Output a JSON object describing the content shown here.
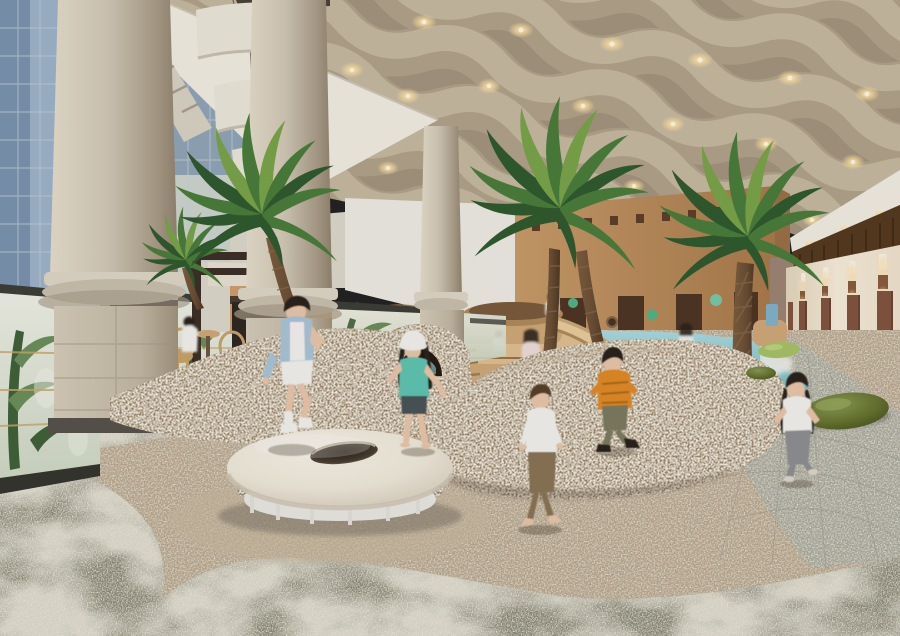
{
  "meta": {
    "title": "Indoor kids playground - architectural concept rendering",
    "type": "photorealistic-render",
    "width": 900,
    "height": 636
  },
  "scene": {
    "setting": "indoor tropical play hall",
    "key_objects": [
      "wavy acoustic ceiling with warm downlights",
      "classical colonnade with printed-glass balustrade",
      "exterior glass building visible at left",
      "cafe pergola with rattan chairs",
      "terracotta wall with colored dots and portholes",
      "rattan lattice dome hut",
      "adobe-style play building with small windows",
      "wooden tiered play structure with slide",
      "shallow pool water",
      "three large indoor palm trees",
      "speckled carpet play mounds with tunnel arch",
      "round cream trampoline disc with center hole",
      "olive pebble bean bags",
      "right wall with timber door panels and sconces"
    ],
    "figures": [
      {
        "name": "boy-jumping",
        "outfit": "light blue shirt, white shorts, white sneakers"
      },
      {
        "name": "girl-teal",
        "outfit": "white bucket hat, teal tee, dark shorts, barefoot"
      },
      {
        "name": "boy-walking",
        "outfit": "white long sleeve, brown pants, barefoot"
      },
      {
        "name": "toddler-orange",
        "outfit": "orange jacket, olive pants, dark shoes"
      },
      {
        "name": "girl-running",
        "outfit": "white tee, gray jeans"
      },
      {
        "name": "girl-on-platform",
        "outfit": "pink-white"
      },
      {
        "name": "girl-in-water",
        "outfit": "white"
      },
      {
        "name": "woman-with-child-poolside",
        "outfit": "white"
      },
      {
        "name": "cafe-woman",
        "outfit": "white top"
      }
    ]
  },
  "colors": {
    "glass_building": "#9db4c9",
    "glass_building_dark": "#7a93ad",
    "glass_frame": "#c3d0dc",
    "ceiling_base": "#a3947d",
    "ceiling_wave_light": "#c6b9a1",
    "ceiling_wave_mid": "#b0a289",
    "ceiling_wave_dark": "#6f6351",
    "ceiling_glow": "#ffdf9e",
    "ceiling_glow_core": "#fff6d8",
    "soffit_white": "#f1ece1",
    "soffit_shadow": "#d9d2c3",
    "sail_white": "#ebe6da",
    "column_light": "#ded5c4",
    "column_mid": "#c9bfae",
    "column_shade": "#a99c88",
    "plinth_dark": "#57524a",
    "wall_white": "#edeae2",
    "wall_white_shade": "#dcd7cb",
    "terracotta": "#c3905f",
    "terracotta_light": "#cf9e6c",
    "adobe": "#b9875a",
    "adobe_lit": "#c89b69",
    "adobe_dark": "#a97a4b",
    "adobe_window": "#5d3f2a",
    "adobe_door": "#4f3524",
    "mauve_wall": "#9e8474",
    "clerestory_slat": "#55391f",
    "clerestory_gap": "#33220f",
    "rightwall_cream": "#efe2cd",
    "rightwall_warm": "#f7ecd9",
    "panel_brown": "#815440",
    "sconce_brown": "#8a5c3c",
    "sconce_glow": "#ffe3ae",
    "window_pane": "#f8f2e6",
    "dome_tan": "#d2a873",
    "dome_dark": "#a97f50",
    "dome_opening": "#7c5c3a",
    "dot_green": "#54b386",
    "dot_teal": "#79c8a6",
    "dot_coral": "#dd8a72",
    "porthole_rim": "#8a6746",
    "porthole_dark": "#463425",
    "wood_light": "#e0bf92",
    "wood_mid": "#cfa878",
    "wood_dark": "#b08a5c",
    "wood_edge": "#9a7348",
    "water_light": "#aadbe2",
    "water_deep": "#6fb3bd",
    "water_sparkle": "#e4f4f5",
    "pool_tile": "#c7cbc4",
    "pebble_olive": "#66732f",
    "pebble_olive_dark": "#4a561f",
    "pebble_olive_light": "#8a9a52",
    "pebble_green_light": "#a9c167",
    "mound_base": "#9b8568",
    "mound_shade": "#7e6a52",
    "mound_light": "#b5a081",
    "sand_carpet": "#b7a68d",
    "sand_carpet_light": "#c8b89e",
    "green_carpet": "#8b8877",
    "green_carpet_dark": "#6f6d5d",
    "green_carpet_light": "#b0ab93",
    "tile_gray": "#a8a99d",
    "tile_gray_line": "#8f9083",
    "tramp_top": "#efe8da",
    "tramp_rim": "#d8cfbe",
    "tramp_hole": "#2a221a",
    "tramp_base": "#e9e7e1",
    "tramp_shadow": "#55504a",
    "skin": "#e9c6a9",
    "hair_dark": "#2c241d",
    "hair_brown": "#55402c",
    "fig_blue_shirt": "#a9c3d6",
    "fig_white": "#f2f1ec",
    "fig_teal": "#5fc4b2",
    "fig_dark_shorts": "#4a5257",
    "fig_khaki": "#8a7354",
    "fig_orange": "#e08a28",
    "fig_olive_pants": "#7c7a5e",
    "fig_gray_jeans": "#8d8f93",
    "pergola_dark": "#3c2f26",
    "rattan": "#c7a368",
    "gold_line": "#c9a96a",
    "leaf_green": "#6a8f5a",
    "leaf_dark": "#3f6138",
    "palm_dark": "#2f5a2f",
    "palm_mid": "#4a7d3a",
    "palm_light": "#7aa348",
    "trunk_brown": "#6b4f35",
    "trunk_dark": "#4e3824",
    "trunk_ring": "#8a6a47"
  }
}
